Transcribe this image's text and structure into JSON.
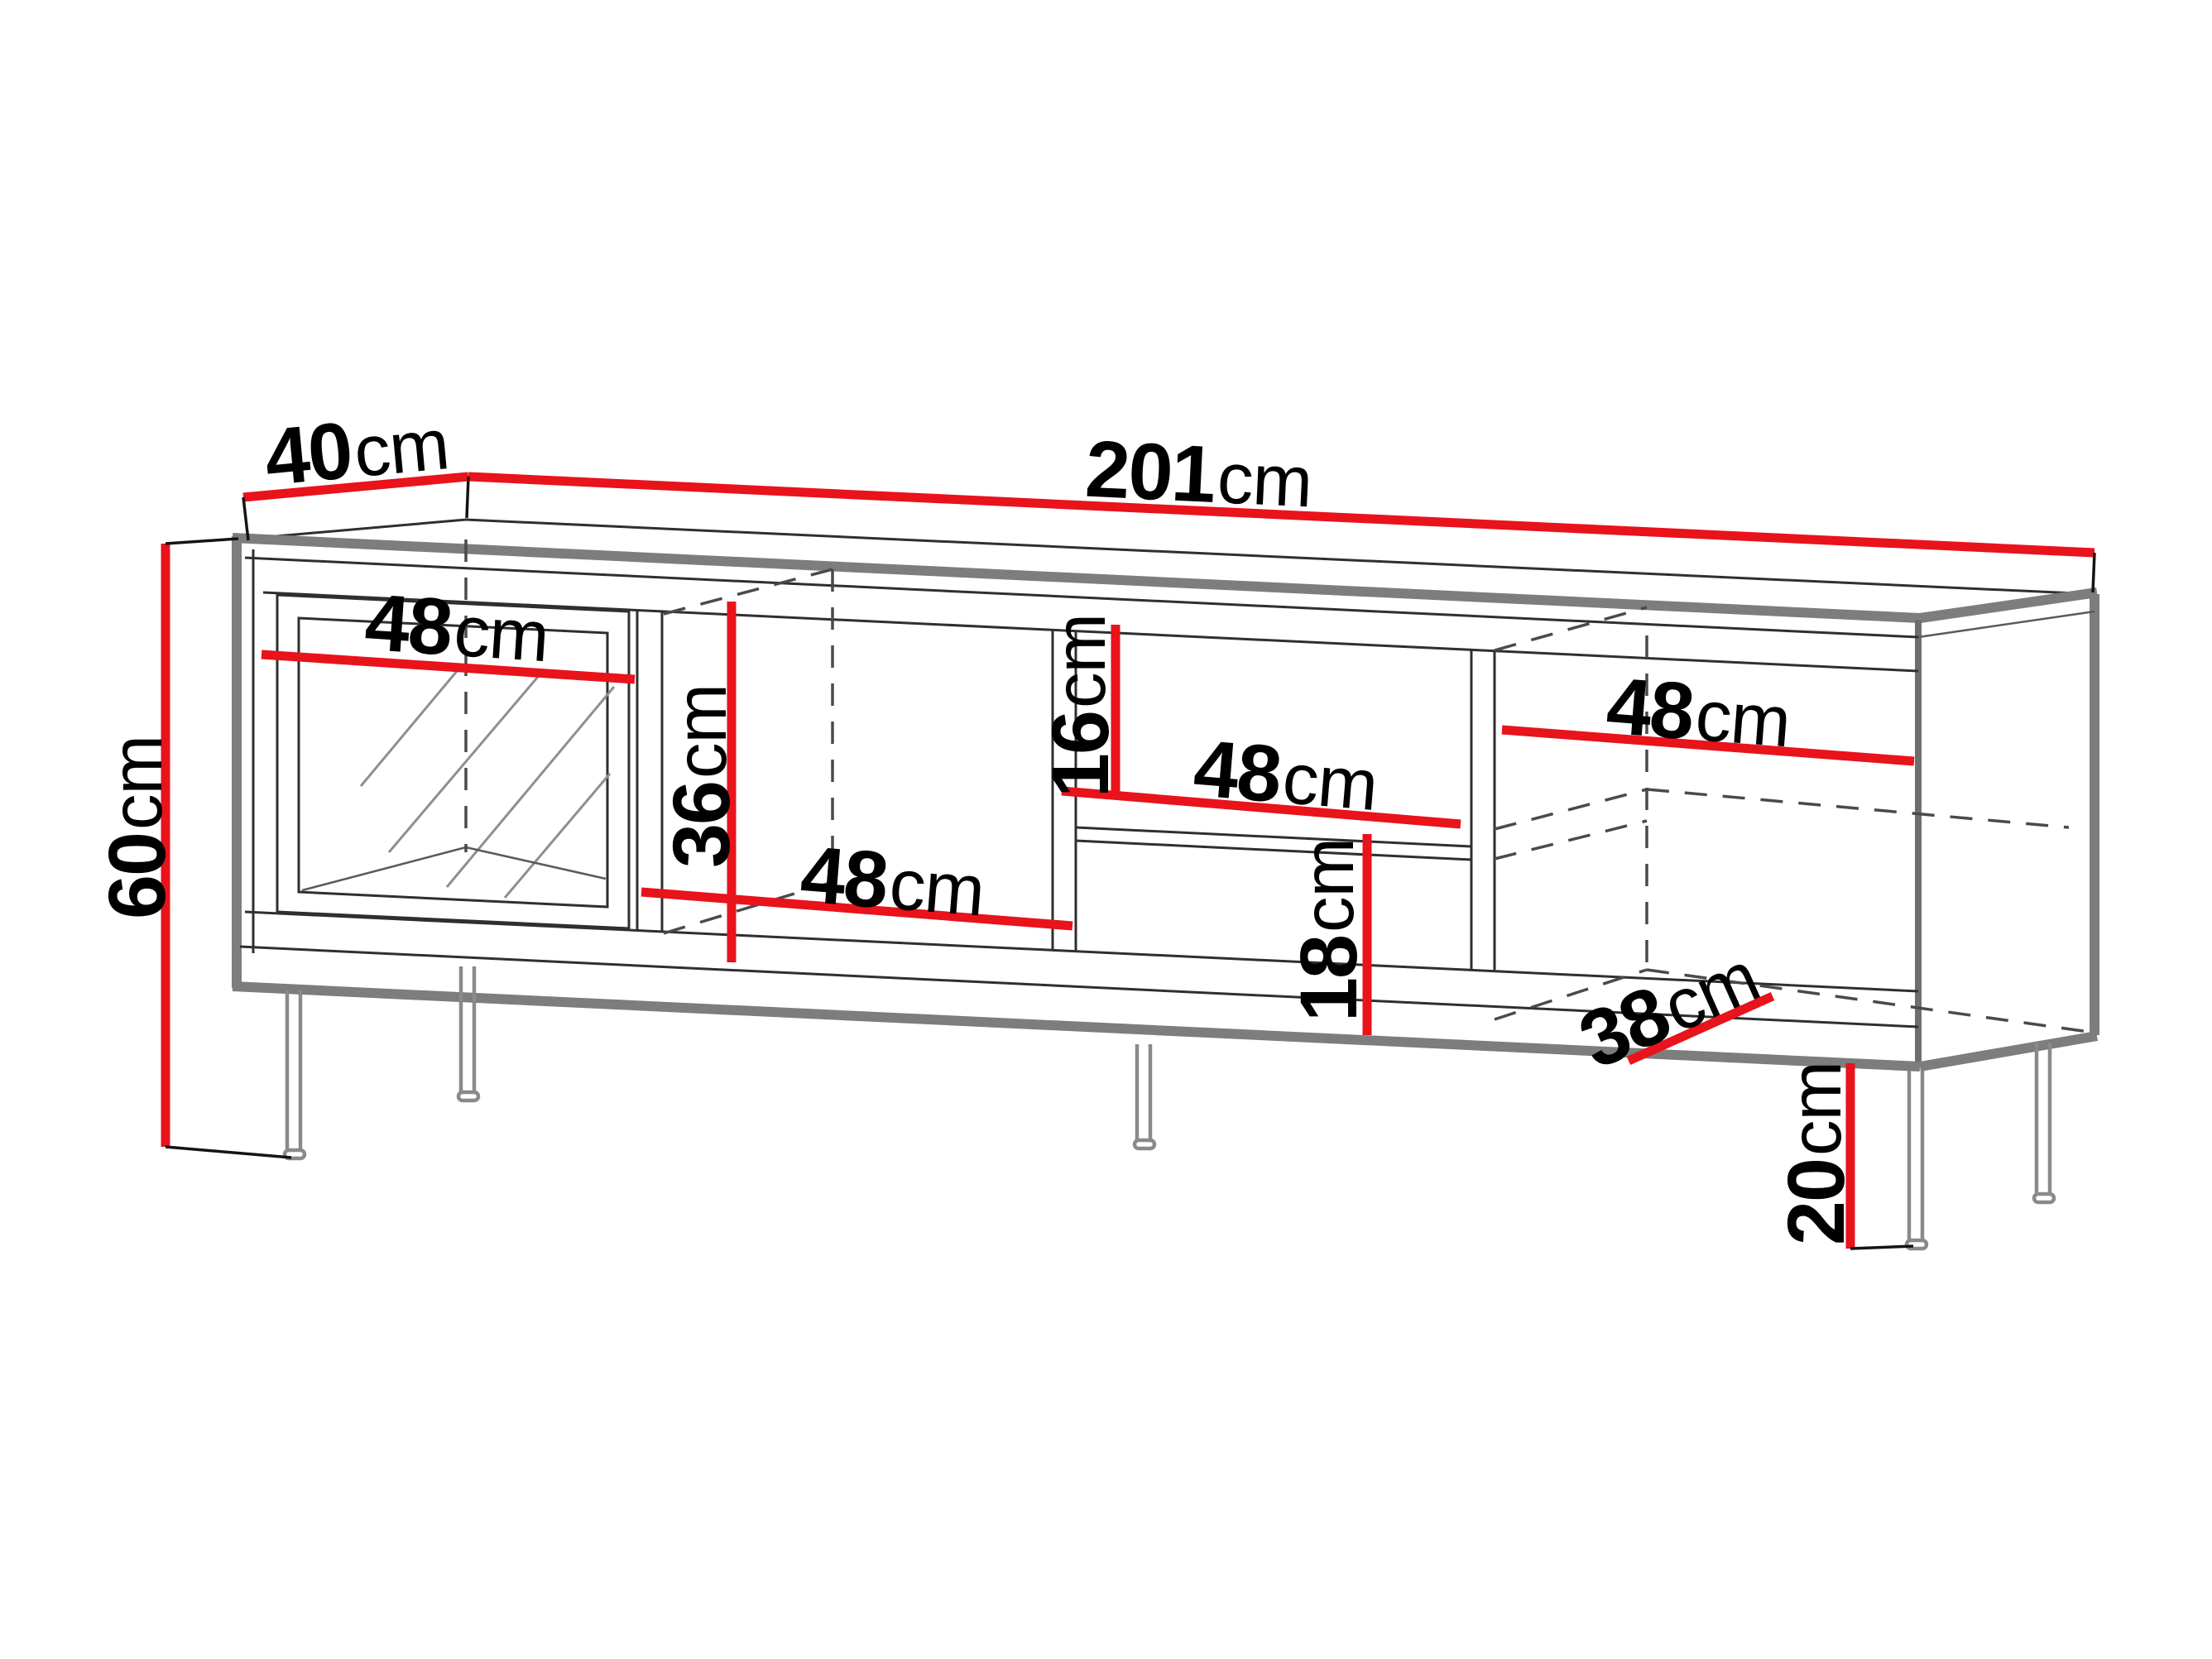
{
  "diagram": {
    "unit": "cm",
    "colors": {
      "dimension_accent": "#e8131b",
      "outline": "#2f2f2f",
      "soft_edge": "#7d7d7d"
    },
    "dimensions": {
      "depth_top": {
        "value": "40",
        "unit": "cm"
      },
      "total_width": {
        "value": "201",
        "unit": "cm"
      },
      "body_height": {
        "value": "60",
        "unit": "cm"
      },
      "left_door_width": {
        "value": "48",
        "unit": "cm"
      },
      "comp2_height": {
        "value": "36",
        "unit": "cm"
      },
      "comp2_width": {
        "value": "48",
        "unit": "cm"
      },
      "shelf_gap_top": {
        "value": "16",
        "unit": "cm"
      },
      "shelf_width": {
        "value": "48",
        "unit": "cm"
      },
      "shelf_gap_bottom": {
        "value": "18",
        "unit": "cm"
      },
      "right_section_width": {
        "value": "48",
        "unit": "cm"
      },
      "floor_depth": {
        "value": "38",
        "unit": "cm"
      },
      "leg_height": {
        "value": "20",
        "unit": "cm"
      }
    }
  }
}
